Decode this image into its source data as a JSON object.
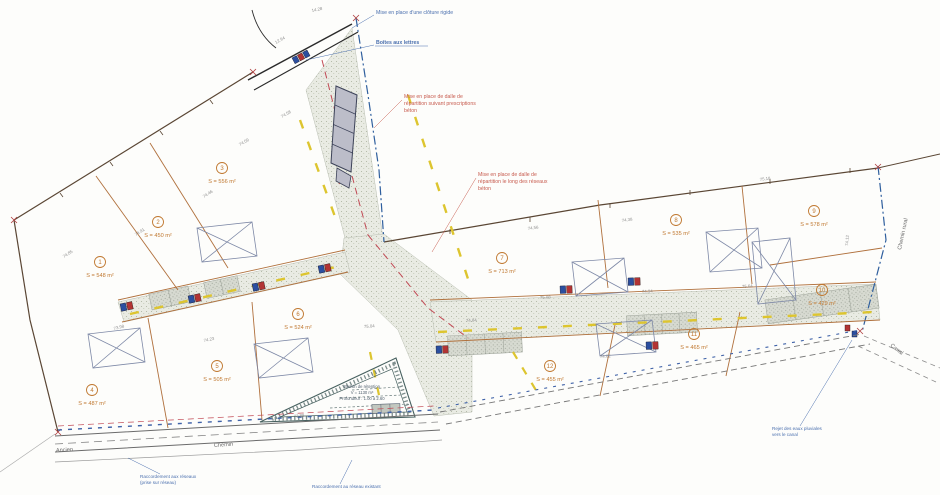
{
  "lots": [
    {
      "number": "1",
      "area": "S = 548 m²"
    },
    {
      "number": "2",
      "area": "S = 450 m²"
    },
    {
      "number": "3",
      "area": "S = 556 m²"
    },
    {
      "number": "4",
      "area": "S = 487 m²"
    },
    {
      "number": "5",
      "area": "S = 505 m²"
    },
    {
      "number": "6",
      "area": "S = 524 m²"
    },
    {
      "number": "7",
      "area": "S = 713 m²"
    },
    {
      "number": "8",
      "area": "S = 535 m²"
    },
    {
      "number": "9",
      "area": "S = 578 m²"
    },
    {
      "number": "10",
      "area": "S = 429 m²"
    },
    {
      "number": "11",
      "area": "S = 465 m²"
    },
    {
      "number": "12",
      "area": "S = 455 m²"
    }
  ],
  "annotations": {
    "fence_note": "Mise en place d'une clôture rigide",
    "mailboxes_note": "Boîtes aux lettres",
    "slab_note_1": [
      "Mise en place de dalle de",
      "répartition suivant prescriptions",
      "béton"
    ],
    "slab_note_2": [
      "Mise en place de dalle de",
      "répartition le long des réseaux",
      "béton"
    ],
    "connection_note": [
      "Raccordement aux réseaux",
      "(prise sur réseau)"
    ],
    "sewer_note": "Raccordement au réseau existant",
    "outfall_note": [
      "Rejet des eaux pluviales",
      "vers le canal"
    ]
  },
  "basin": {
    "line1": "Bassin de rétention",
    "line2": "V = 1130 m³",
    "line3": "Profondeur : 1.00 à 2.60"
  },
  "streets": {
    "ancien": "Ancien",
    "chemin": "Chemin",
    "canal": "Canal",
    "chemin_rural": "Chemin rural"
  },
  "spot_values": [
    "74.85",
    "74.91",
    "74.46",
    "74.09",
    "74.58",
    "12.94",
    "14.28",
    "73.98",
    "74.23",
    "75.04",
    "74.84",
    "75.08",
    "74.94",
    "75.64",
    "74.56",
    "74.38",
    "75.18",
    "74.12",
    "73.88",
    "74.62"
  ],
  "colors": {
    "road_fill": "#e9ebe3",
    "lot_line": "#b0703c",
    "lot_label": "#c07830",
    "boundary": "#5a4634",
    "boundary_blue": "#2f5f9e",
    "gas_yellow": "#ddc52f",
    "water_red": "#c24a55",
    "note_red": "#c75b4e",
    "note_blue": "#4a6fae"
  }
}
